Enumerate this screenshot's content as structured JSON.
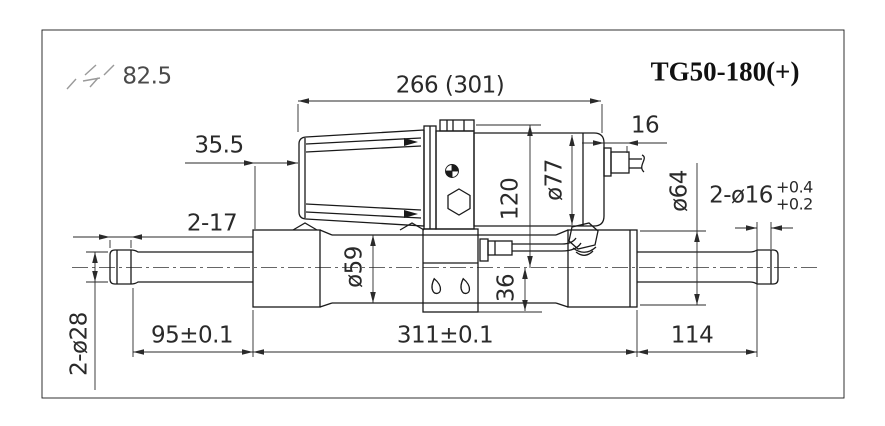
{
  "drawing": {
    "title": "TG50-180(+)",
    "corner_note": "82.5",
    "dimensions": {
      "overall_top": "266 (301)",
      "motor_offset": "35.5",
      "connector": "16",
      "left_cap": "2-17",
      "left_shaft_dia": "2-ø28",
      "left_length": "95±0.1",
      "body_length": "311±0.1",
      "right_length": "114",
      "tube_dia": "ø59",
      "motor_height": "120",
      "motor_dia": "ø77",
      "bracket_drop": "36",
      "end_dia": "ø64",
      "pin_holes": "2-ø16",
      "pin_tol_upper": "+0.4",
      "pin_tol_lower": "+0.2"
    },
    "colors": {
      "line": "#1a1a1a",
      "dim": "#2a2a2a",
      "faint": "#9a9a9a",
      "background": "#ffffff"
    }
  }
}
